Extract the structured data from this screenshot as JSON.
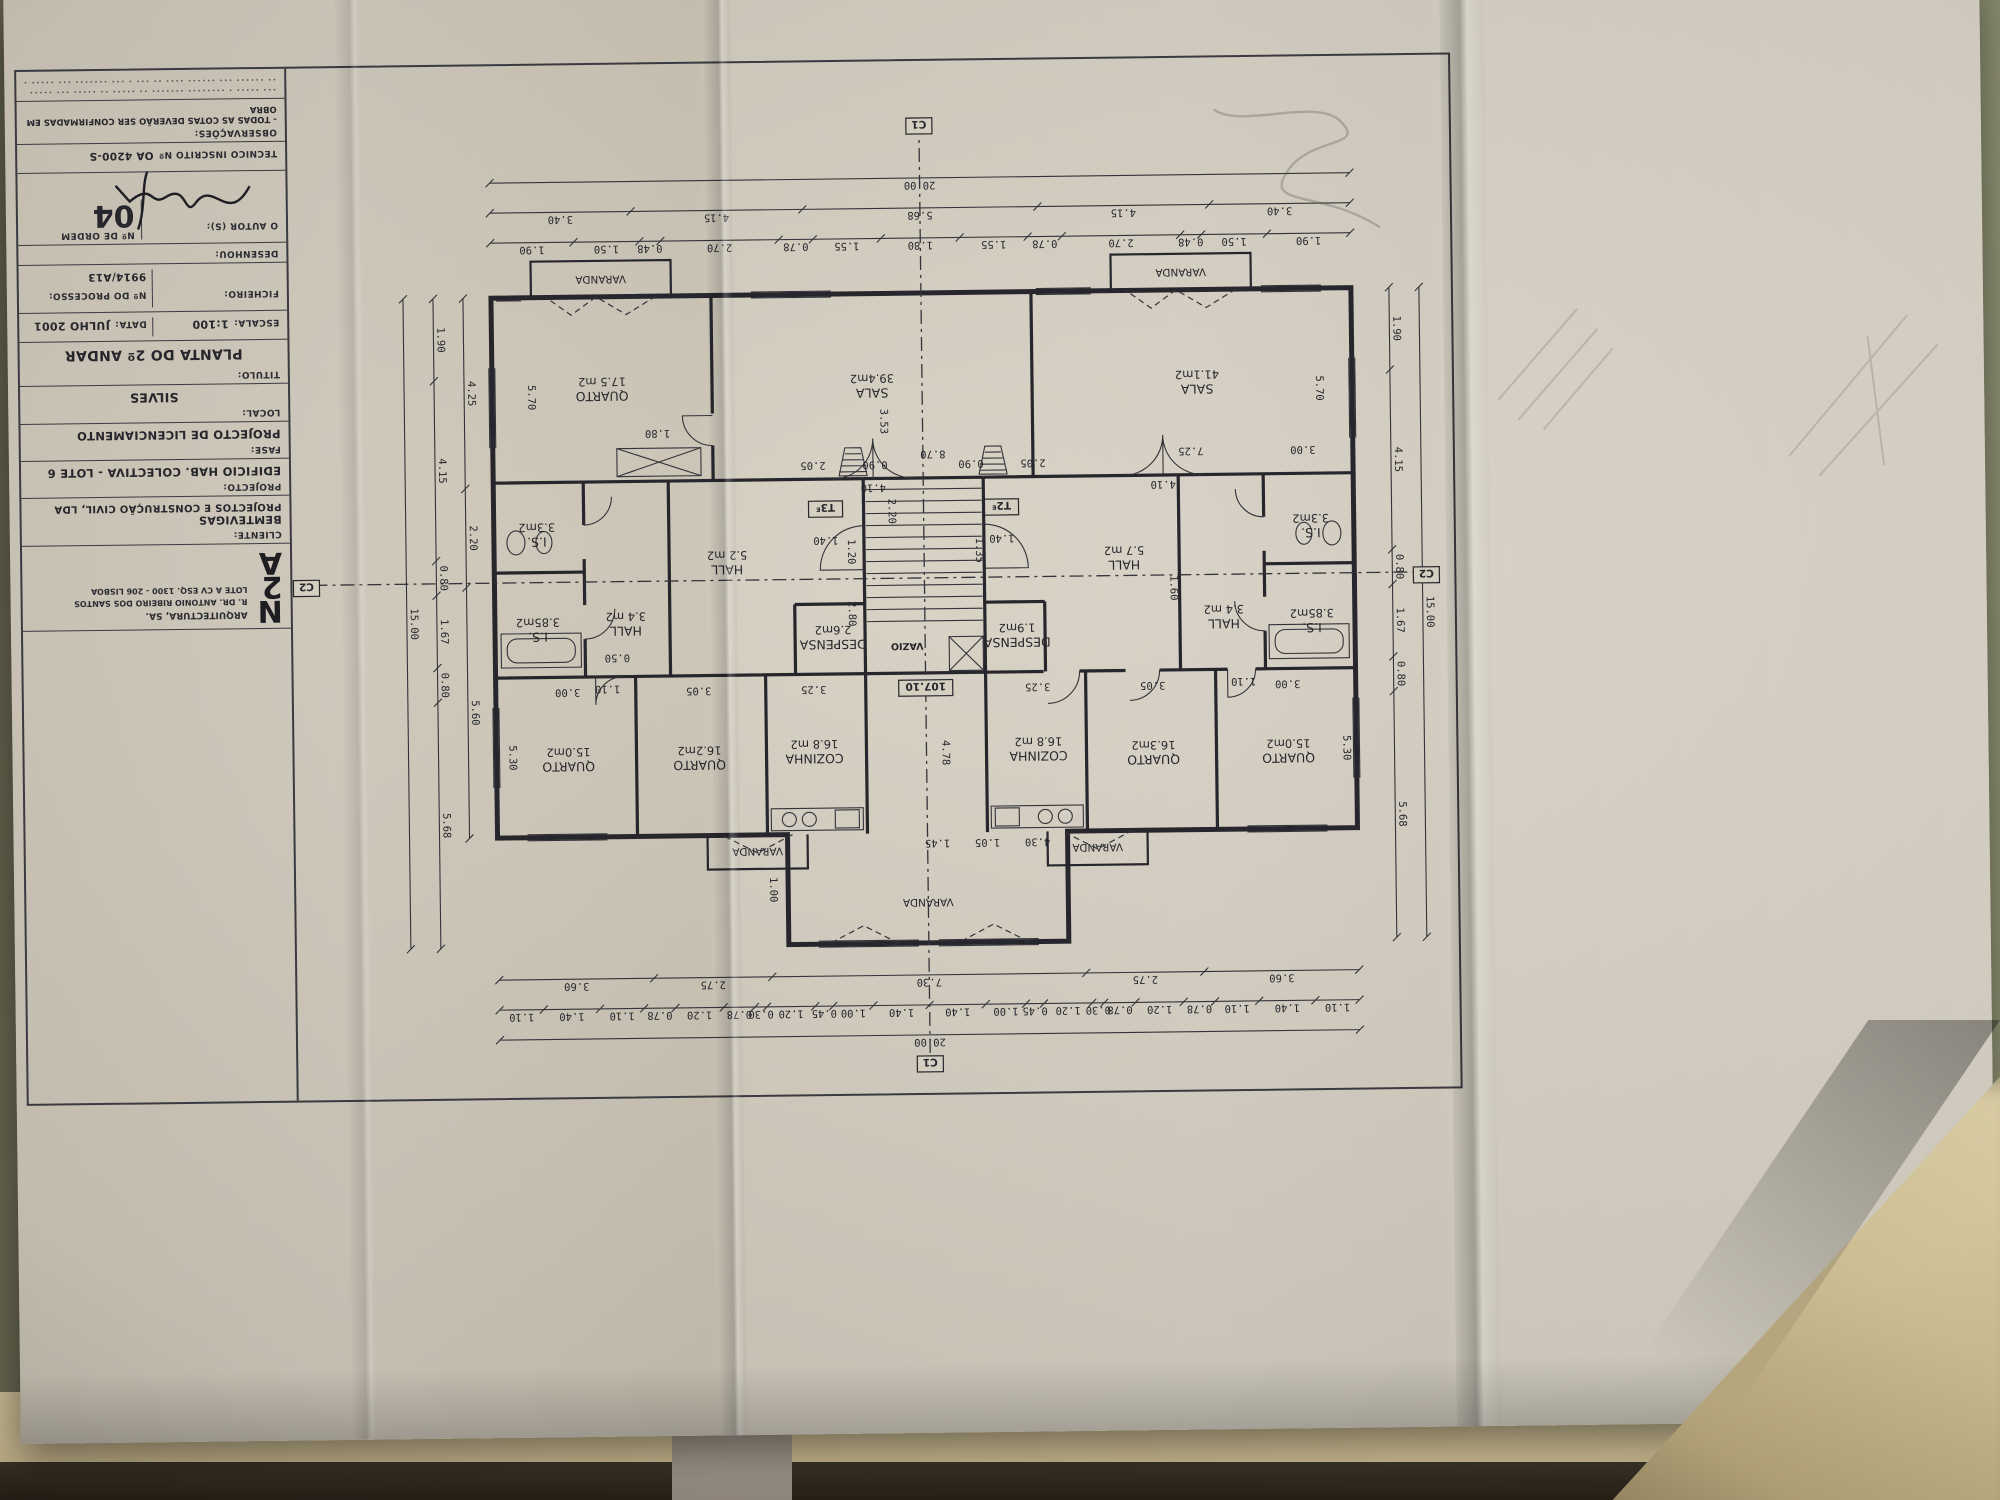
{
  "title_block": {
    "logo": {
      "l1": "N",
      "l2": "2",
      "l3": "A",
      "company": "ARQUITECTURA, SA.",
      "address1": "R. DR. ANTONIO RIBEIRO DOS SANTOS",
      "address2": "LOTE A CV ESQ. 1300 - 206 LISBOA"
    },
    "cliente_label": "CLIENTE:",
    "cliente_line1": "BEMTEVIGAS",
    "cliente_line2": "PROJECTOS E CONSTRUÇÃO CIVIL, LDA",
    "projecto_label": "PROJECTO:",
    "projecto_value": "EDIFICIO  HAB.  COLECTIVA - LOTE 6",
    "fase_label": "FASE:",
    "fase_value": "PROJECTO DE LICENCIAMENTO",
    "local_label": "LOCAL:",
    "local_value": "SILVES",
    "titulo_label": "TITULO:",
    "titulo_value": "PLANTA DO 2º ANDAR",
    "escala_label": "ESCALA:",
    "escala_value": "1:100",
    "data_label": "DATA:",
    "data_value": "JULHO 2001",
    "ficheiro_label": "FICHEIRO:",
    "processo_label": "Nº DO PROCESSO:",
    "processo_value": "9914/A13",
    "desenhou_label": "DESENHOU:",
    "autor_label": "O AUTOR (S):",
    "ordem_label": "Nº DE ORDEM",
    "ordem_value": "04",
    "tecnico_label": "TECNICO INSCRITO Nº",
    "tecnico_value": "OA 4200-S",
    "obs_label": "OBSERVAÇÕES:",
    "obs_value": "- TODAS AS COTAS DEVERÃO SER CONFIRMADAS EM OBRA",
    "fineprint1": "∙∙∙ ∙∙∙∙∙ ∙ ∙∙∙∙∙∙∙∙ ∙∙∙∙∙∙∙ ∙∙ ∙∙∙∙∙ ∙∙ ∙∙∙∙∙ ∙∙∙ ∙∙∙∙∙ ∙∙∙ ∙∙∙∙∙∙∙ ∙∙∙ ∙∙∙∙ ∙ ∙∙∙ ∙∙∙∙",
    "fineprint2": "∙∙ ∙∙∙∙∙∙ ∙∙∙ ∙∙∙∙∙∙ ∙∙∙∙ ∙∙ ∙∙∙ ∙ ∙∙∙ ∙∙∙∙∙∙∙ ∙∙∙ ∙∙∙∙∙ ∙∙∙ ∙∙∙∙∙ ∙ ∙∙∙∙∙∙"
  },
  "plan": {
    "markers": {
      "c1": "C1",
      "c2": "C2",
      "level": "107.10",
      "vazio": "VAZIO",
      "unit_left": "T2",
      "unit_right": "T3",
      "entrance_mark": "E"
    },
    "units": [
      {
        "id": "T2",
        "rooms": [
          {
            "name": "SALA",
            "area": "41.1m2",
            "x": 255,
            "y": 695
          },
          {
            "name": "QUARTO",
            "area": "15.0m2",
            "x": 168,
            "y": 325
          },
          {
            "name": "QUARTO",
            "area": "16.3m2",
            "x": 303,
            "y": 325
          },
          {
            "name": "COZINHA",
            "area": "16.8 m2",
            "x": 418,
            "y": 330
          },
          {
            "name": "I.S.",
            "area": "3.85m2",
            "x": 143,
            "y": 455
          },
          {
            "name": "I.S.",
            "area": "3.3m2",
            "x": 143,
            "y": 550
          },
          {
            "name": "HALL",
            "area": "3.4 m2",
            "x": 231,
            "y": 460
          },
          {
            "name": "HALL",
            "area": "5.7 m2",
            "x": 330,
            "y": 520
          },
          {
            "name": "DESPENSA",
            "area": "1.9m2",
            "x": 438,
            "y": 444
          }
        ]
      },
      {
        "id": "T3",
        "rooms": [
          {
            "name": "SALA",
            "area": "39.4m2",
            "x": 580,
            "y": 695
          },
          {
            "name": "QUARTO",
            "area": "17.5 m2",
            "x": 850,
            "y": 695
          },
          {
            "name": "QUARTO",
            "area": "16.2m2",
            "x": 757,
            "y": 325
          },
          {
            "name": "QUARTO",
            "area": "15.0m2",
            "x": 888,
            "y": 325
          },
          {
            "name": "COZINHA",
            "area": "16.8 m2",
            "x": 642,
            "y": 330
          },
          {
            "name": "I.S.",
            "area": "3.85m2",
            "x": 917,
            "y": 455
          },
          {
            "name": "I.S.",
            "area": "3.3m2",
            "x": 917,
            "y": 550
          },
          {
            "name": "HALL",
            "area": "3.4 m2",
            "x": 829,
            "y": 460
          },
          {
            "name": "HALL",
            "area": "5.2 m2",
            "x": 727,
            "y": 520
          },
          {
            "name": "DESPENSA",
            "area": "2.6m2",
            "x": 622,
            "y": 444
          }
        ]
      }
    ],
    "varandas": [
      {
        "t": "VARANDA",
        "x": 530,
        "y": 184
      },
      {
        "t": "VARANDA",
        "x": 270,
        "y": 811
      },
      {
        "t": "VARANDA",
        "x": 850,
        "y": 811
      },
      {
        "t": "VARANDA",
        "x": 360,
        "y": 237
      },
      {
        "t": "VARANDA",
        "x": 700,
        "y": 237
      }
    ],
    "dims": [
      {
        "t": "5.70",
        "x": 136,
        "y": 690,
        "v": 1
      },
      {
        "t": "5.70",
        "x": 924,
        "y": 690,
        "v": 1
      },
      {
        "t": "8.70",
        "x": 520,
        "y": 632,
        "v": 0
      },
      {
        "t": "3.53",
        "x": 572,
        "y": 662,
        "v": 1
      },
      {
        "t": "7.25",
        "x": 262,
        "y": 632,
        "v": 0
      },
      {
        "t": "3.00",
        "x": 150,
        "y": 632,
        "v": 0
      },
      {
        "t": "4.10",
        "x": 290,
        "y": 599,
        "v": 0
      },
      {
        "t": "4.10",
        "x": 580,
        "y": 599,
        "v": 0
      },
      {
        "t": "1.10",
        "x": 212,
        "y": 401,
        "v": 0
      },
      {
        "t": "1.10",
        "x": 848,
        "y": 401,
        "v": 0
      },
      {
        "t": "1.80",
        "x": 795,
        "y": 656,
        "v": 0
      },
      {
        "t": "1.60",
        "x": 284,
        "y": 492,
        "v": 1
      },
      {
        "t": "2.80",
        "x": 606,
        "y": 470,
        "v": 1
      },
      {
        "t": "1.20",
        "x": 606,
        "y": 532,
        "v": 1
      },
      {
        "t": "4.30",
        "x": 420,
        "y": 243,
        "v": 0
      },
      {
        "t": "1.05",
        "x": 470,
        "y": 243,
        "v": 0
      },
      {
        "t": "1.45",
        "x": 520,
        "y": 243,
        "v": 0
      },
      {
        "t": "0.90",
        "x": 482,
        "y": 622,
        "v": 0
      },
      {
        "t": "0.90",
        "x": 578,
        "y": 622,
        "v": 0
      },
      {
        "t": "2.05",
        "x": 420,
        "y": 622,
        "v": 0
      },
      {
        "t": "2.05",
        "x": 640,
        "y": 622,
        "v": 0
      },
      {
        "t": "1.35",
        "x": 478,
        "y": 532,
        "v": 1
      },
      {
        "t": "1.40",
        "x": 452,
        "y": 547,
        "v": 0
      },
      {
        "t": "1.40",
        "x": 628,
        "y": 547,
        "v": 0
      },
      {
        "t": "5.30",
        "x": 113,
        "y": 330,
        "v": 1
      },
      {
        "t": "5.30",
        "x": 947,
        "y": 330,
        "v": 1
      },
      {
        "t": "3.05",
        "x": 303,
        "y": 398,
        "v": 0
      },
      {
        "t": "3.05",
        "x": 757,
        "y": 398,
        "v": 0
      },
      {
        "t": "3.25",
        "x": 418,
        "y": 398,
        "v": 0
      },
      {
        "t": "3.25",
        "x": 642,
        "y": 398,
        "v": 0
      },
      {
        "t": "3.00",
        "x": 168,
        "y": 398,
        "v": 0
      },
      {
        "t": "3.00",
        "x": 888,
        "y": 398,
        "v": 0
      },
      {
        "t": "4.78",
        "x": 514,
        "y": 330,
        "v": 1
      },
      {
        "t": "1.00",
        "x": 688,
        "y": 195,
        "v": 1
      },
      {
        "t": "0.50",
        "x": 838,
        "y": 432,
        "v": 0
      },
      {
        "t": "2.20",
        "x": 565,
        "y": 572,
        "v": 1
      }
    ],
    "chains": [
      {
        "axis": "h",
        "pos": 48,
        "from": 100,
        "to": 960,
        "values": [
          "20.00"
        ]
      },
      {
        "axis": "h",
        "pos": 78,
        "from": 100,
        "to": 960,
        "values": [
          "1.10",
          "1.40",
          "1.10",
          "0.78",
          "1.20",
          "0.78",
          "0.30",
          "1.20",
          "0.45",
          "1.00",
          "1.40",
          "1.40",
          "1.00",
          "0.45",
          "1.20",
          "0.30",
          "0.78",
          "1.20",
          "0.78",
          "1.10",
          "1.40",
          "1.10"
        ]
      },
      {
        "axis": "h",
        "pos": 108,
        "from": 100,
        "to": 960,
        "values": [
          "3.60",
          "2.75",
          "7.30",
          "2.75",
          "3.60"
        ]
      },
      {
        "axis": "h",
        "pos": 845,
        "from": 100,
        "to": 960,
        "values": [
          "1.90",
          "1.50",
          "0.48",
          "2.70",
          "0.78",
          "1.55",
          "1.80",
          "1.55",
          "0.78",
          "2.70",
          "0.48",
          "1.50",
          "1.90"
        ]
      },
      {
        "axis": "h",
        "pos": 875,
        "from": 100,
        "to": 960,
        "values": [
          "3.40",
          "4.15",
          "5.68",
          "4.15",
          "3.40"
        ]
      },
      {
        "axis": "h",
        "pos": 905,
        "from": 100,
        "to": 960,
        "values": [
          "20.00"
        ]
      },
      {
        "axis": "v",
        "pos": 62,
        "from": 140,
        "to": 790,
        "values": [
          "5.68",
          "0.80",
          "1.67",
          "0.80",
          "4.15",
          "1.90"
        ]
      },
      {
        "axis": "v",
        "pos": 32,
        "from": 140,
        "to": 790,
        "values": [
          "15.00"
        ]
      },
      {
        "axis": "v",
        "pos": 1018,
        "from": 140,
        "to": 790,
        "values": [
          "5.68",
          "0.80",
          "1.67",
          "0.80",
          "4.15",
          "1.90"
        ]
      },
      {
        "axis": "v",
        "pos": 1048,
        "from": 140,
        "to": 790,
        "values": [
          "15.00"
        ]
      },
      {
        "axis": "v",
        "pos": 988,
        "from": 250,
        "to": 790,
        "values": [
          "5.60",
          "2.20",
          "4.25"
        ]
      }
    ]
  }
}
